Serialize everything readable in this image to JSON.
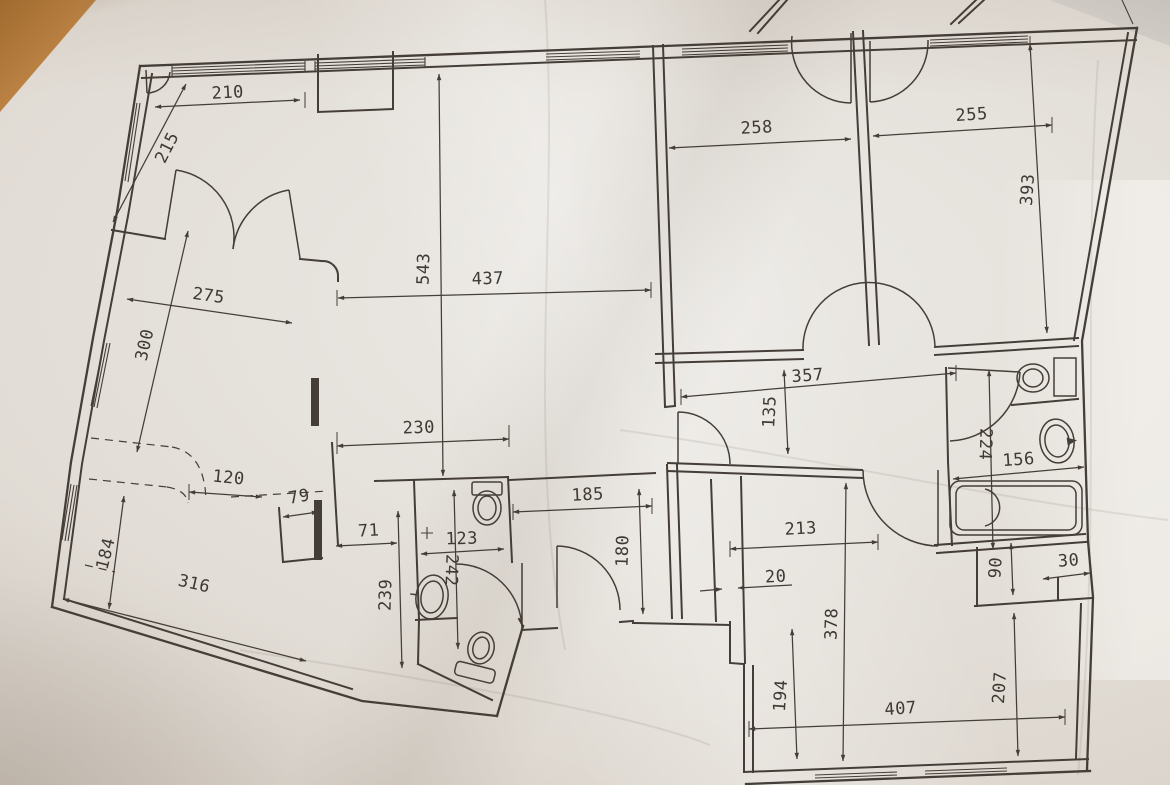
{
  "document": {
    "kind": "floor-plan photograph",
    "line_color": "#453e38",
    "paper_color": "#e2ddd6",
    "table_corner_color": "#c3894a"
  },
  "dims": {
    "d210": "210",
    "d215": "215",
    "d275": "275",
    "d300": "300",
    "d543": "543",
    "d437": "437",
    "d258": "258",
    "d255": "255",
    "d393": "393",
    "d357": "357",
    "d135": "135",
    "d230": "230",
    "d120": "120",
    "d79": "79",
    "d71": "71",
    "d123": "123",
    "d242": "242",
    "d239": "239",
    "d184": "184",
    "d316": "316",
    "d185": "185",
    "d180": "180",
    "d213": "213",
    "d20": "20",
    "d378": "378",
    "d194": "194",
    "d407": "407",
    "d207": "207",
    "d224": "224",
    "d156": "156",
    "d90": "90",
    "d30": "30"
  }
}
